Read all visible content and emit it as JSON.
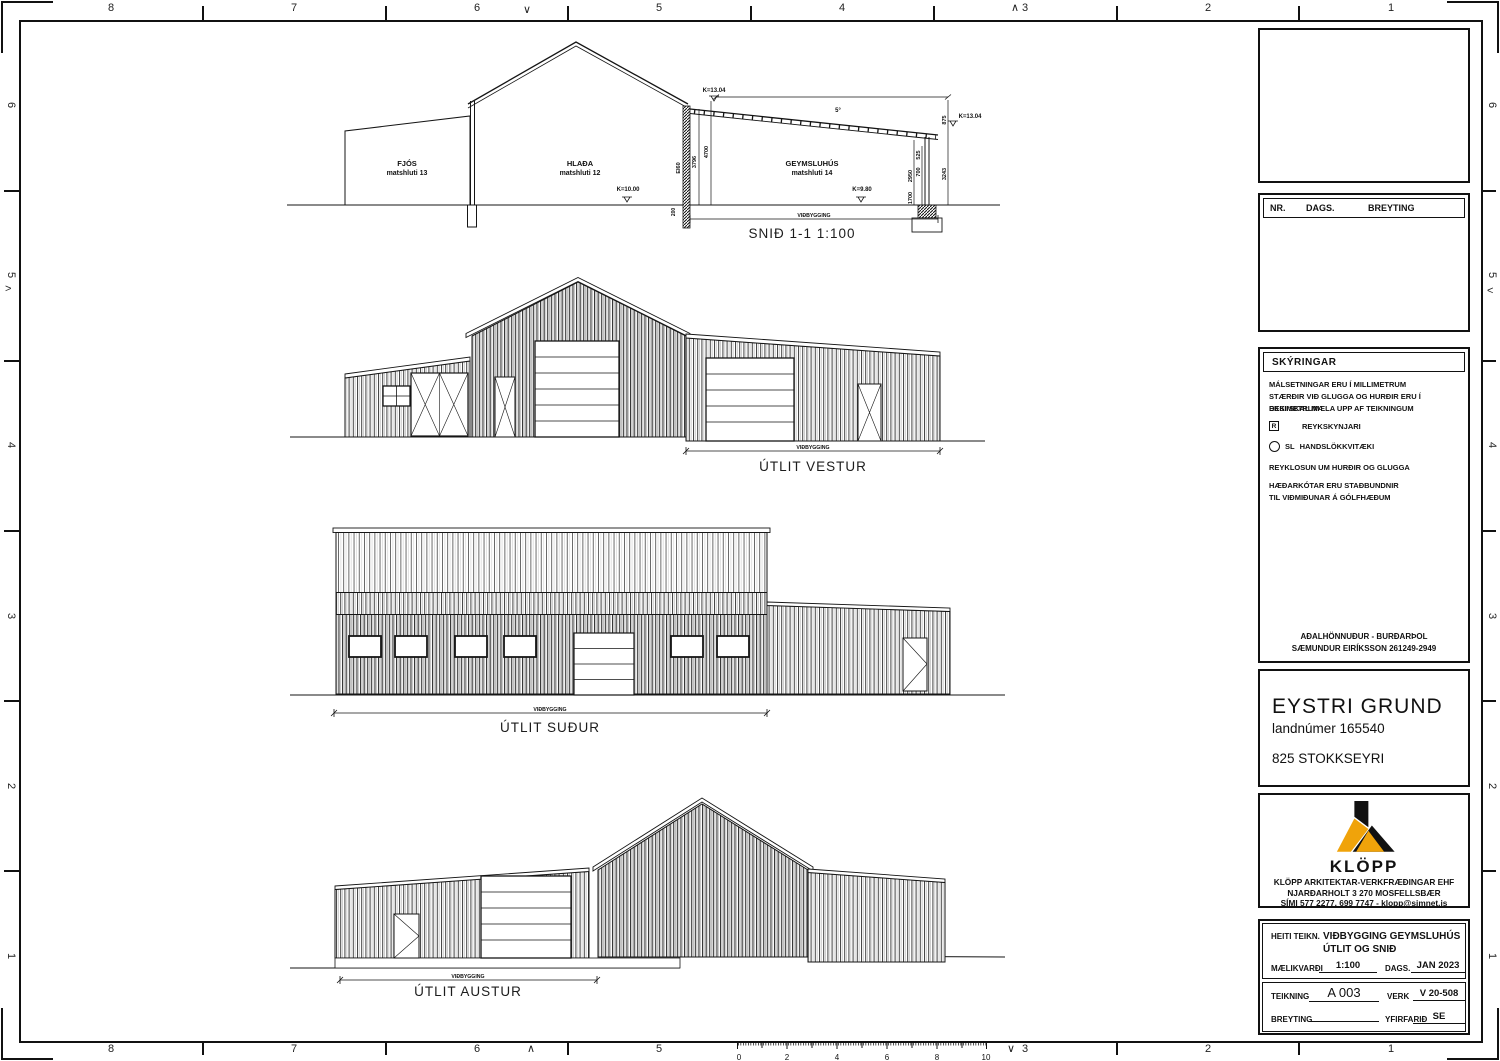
{
  "sheet": {
    "top_numbers": [
      "8",
      "7",
      "6",
      "5",
      "4",
      "3",
      "2",
      "1"
    ],
    "bottom_numbers": [
      "8",
      "7",
      "6",
      "5",
      "3",
      "2",
      "1"
    ],
    "left_numbers": [
      "6",
      "5",
      "4",
      "3",
      "2",
      "1"
    ],
    "right_numbers": [
      "6",
      "5",
      "4",
      "3",
      "2",
      "1"
    ],
    "marks": {
      "v": "∨",
      "caret": "∧",
      "gt": ">",
      "lt": "<"
    }
  },
  "section": {
    "title": "SNIÐ 1-1  1:100",
    "room1": "FJÓS",
    "room1_sub": "matshluti 13",
    "room2": "HLAÐA",
    "room2_sub": "matshluti 12",
    "room3": "GEYMSLUHÚS",
    "room3_sub": "matshluti 14",
    "level_left": "K=13.04",
    "level_right": "K=13.04",
    "level_floor1": "K=10.00",
    "level_floor2": "K=9.80",
    "slope": "5°",
    "wall_rating": "EI60",
    "dim_3796": "3796",
    "dim_4700": "4700",
    "dim_2950": "2950",
    "dim_1700": "1700",
    "dim_700": "700",
    "dim_525": "525",
    "dim_875": "875",
    "dim_3243": "3243",
    "dim_200": "200",
    "extension_label": "VIÐBYGGING"
  },
  "elev_vestur": {
    "title": "ÚTLIT VESTUR",
    "extension_label": "VIÐBYGGING"
  },
  "elev_sudur": {
    "title": "ÚTLIT SUÐUR",
    "extension_label": "VIÐBYGGING"
  },
  "elev_austur": {
    "title": "ÚTLIT AUSTUR",
    "extension_label": "VIÐBYGGING"
  },
  "revisions": {
    "nr": "NR.",
    "dags": "DAGS.",
    "breyting": "BREYTING"
  },
  "notes": {
    "title": "SKÝRINGAR",
    "line1": "MÁLSETNINGAR ERU Í MILLIMETRUM",
    "line2": "STÆRÐIR VIÐ GLUGGA OG HURÐIR ERU Í DESIMETRUM",
    "line3": "EKKI SKAL MÆLA UPP AF TEIKNINGUM",
    "legend1_symbol": "R",
    "legend1": "REYKSKYNJARI",
    "legend2_symbol": "SL",
    "legend2": "HANDSLÖKKVITÆKI",
    "line4": "REYKLOSUN UM HURÐIR OG GLUGGA",
    "line5": "HÆÐARKÓTAR ERU STAÐBUNDNIR",
    "line6": "TIL VIÐMIÐUNAR Á GÓLFHÆÐUM",
    "designer1": "AÐALHÖNNUÐUR - BURÐARÞOL",
    "designer2": "SÆMUNDUR EIRÍKSSON 261249-2949"
  },
  "project": {
    "name": "EYSTRI GRUND",
    "landnumer": "landnúmer 165540",
    "address": "825 STOKKSEYRI"
  },
  "company": {
    "logo": "KLÖPP",
    "line1": "KLÖPP ARKITEKTAR-VERKFRÆÐINGAR EHF",
    "line2": "NJARÐARHOLT 3  270 MOSFELLSBÆR",
    "line3": "SÍMI 577 2277, 699 7747 - klopp@simnet.is",
    "accent": "#F0A30A"
  },
  "titleblock": {
    "heiti_label": "HEITI TEIKN.",
    "heiti_line1": "VIÐBYGGING GEYMSLUHÚS",
    "heiti_line2": "ÚTLIT OG SNIÐ",
    "scale_label": "MÆLIKVARÐI",
    "scale": "1:100",
    "dags_label": "DAGS.",
    "dags": "JAN 2023",
    "teikning_label": "TEIKNING",
    "teikning": "A 003",
    "verk_label": "VERK",
    "verk": "V 20-508",
    "breyting_label": "BREYTING",
    "breyting": "",
    "yfirfarid_label": "YFIRFARIÐ",
    "yfirfarid": "SE"
  },
  "ruler": {
    "labels": [
      "0",
      "2",
      "4",
      "6",
      "8",
      "10"
    ]
  }
}
